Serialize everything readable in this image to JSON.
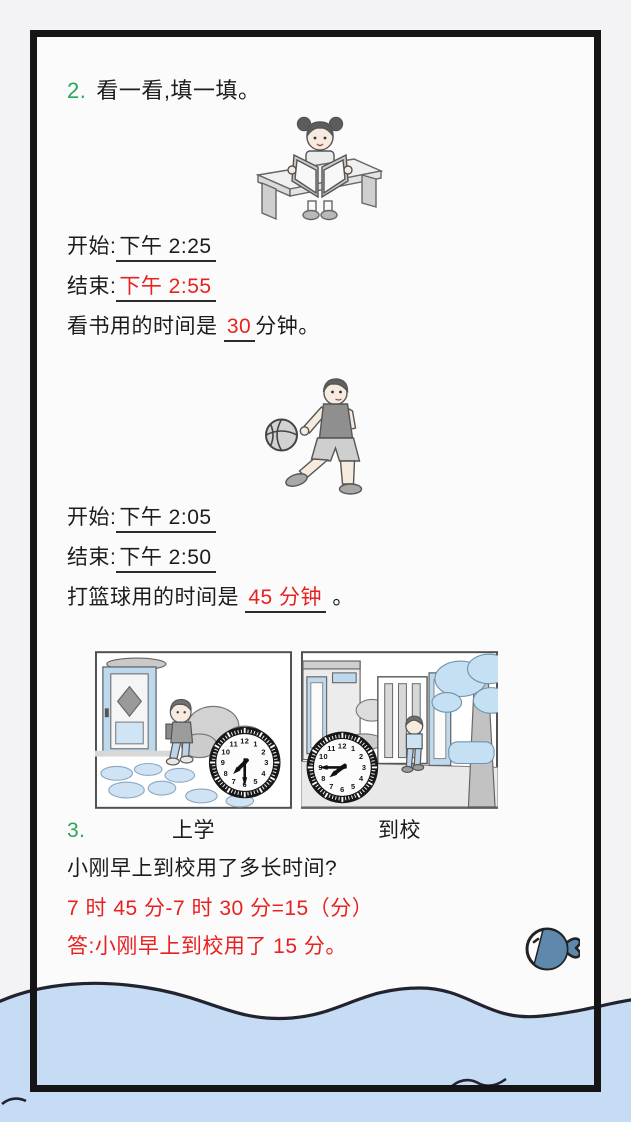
{
  "page": {
    "q2": {
      "number": "2.",
      "title": "看一看,填一填。",
      "reading": {
        "start_label": "开始:",
        "start_value": "下午 2:25",
        "end_label": "结束:",
        "end_value": "下午 2:55",
        "duration_prefix": "看书用的时间是",
        "duration_value": "30",
        "duration_suffix": "分钟。"
      },
      "basketball": {
        "start_label": "开始:",
        "start_value": "下午 2:05",
        "end_label": "结束:",
        "end_value": "下午 2:50",
        "duration_prefix": "打篮球用的时间是",
        "duration_value": "45 分钟",
        "duration_suffix": "。"
      }
    },
    "q3": {
      "number": "3.",
      "pictures": [
        {
          "label": "上学",
          "clock_time": "7:30"
        },
        {
          "label": "到校",
          "clock_time": "7:45"
        }
      ],
      "question": "小刚早上到校用了多长时间?",
      "equation": "7 时 45 分-7 时 30 分=15（分）",
      "answer": "答:小刚早上到校用了 15 分。"
    },
    "colors": {
      "question_number_green": "#2ba55c",
      "answer_red": "#e82121",
      "water_blue": "#c6dbf4",
      "illustration_blue": "#c5e0f2"
    }
  }
}
